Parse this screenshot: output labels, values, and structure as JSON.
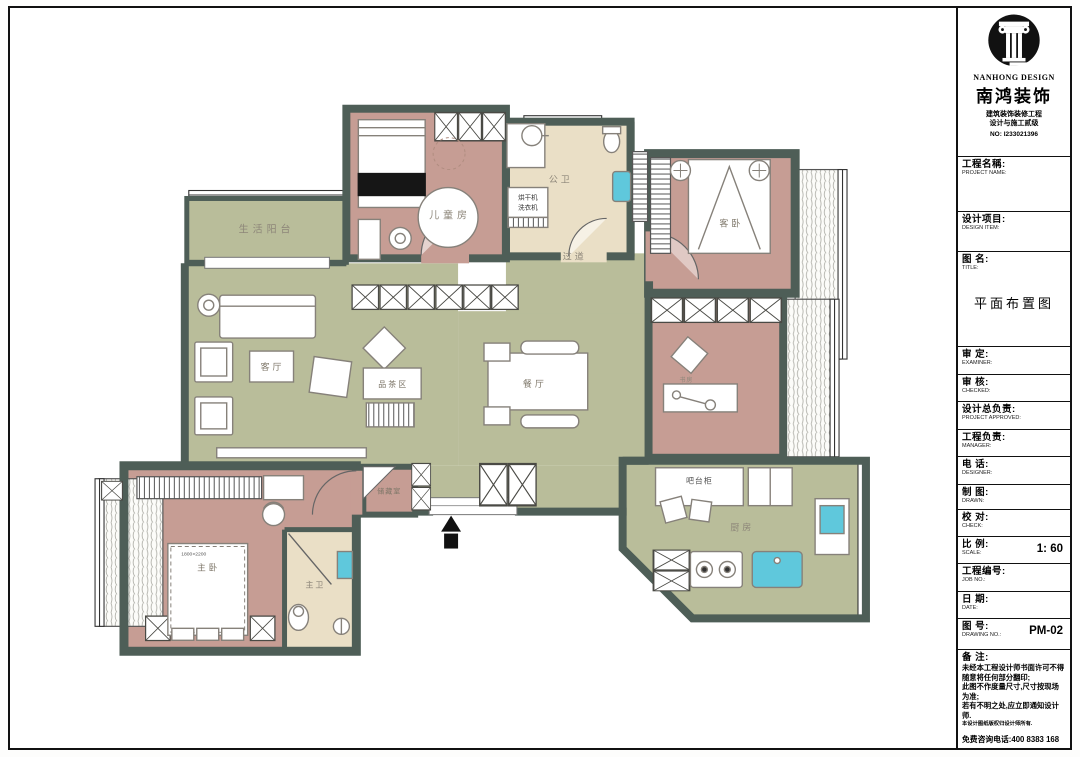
{
  "title_block": {
    "logo": {
      "brand_en": "NANHONG DESIGN",
      "brand_cn": "南鸿装饰",
      "cert_line1": "建筑装饰装修工程",
      "cert_line2": "设计与施工贰级",
      "license_no": "NO: I233021396"
    },
    "fields": [
      {
        "cn": "工程名稱:",
        "en": "PROJECT NAME:",
        "value": ""
      },
      {
        "cn": "设计项目:",
        "en": "DESIGN ITEM:",
        "value": ""
      },
      {
        "cn": "图  名:",
        "en": "TITLE:",
        "value": "平面布置图"
      },
      {
        "cn": "审  定:",
        "en": "EXAMINER:",
        "value": ""
      },
      {
        "cn": "审  核:",
        "en": "CHECKED:",
        "value": ""
      },
      {
        "cn": "设计总负责:",
        "en": "PROJECT APPROVED:",
        "value": ""
      },
      {
        "cn": "工程负责:",
        "en": "MANAGER:",
        "value": ""
      },
      {
        "cn": "电  话:",
        "en": "DESIGNER:",
        "value": ""
      },
      {
        "cn": "制  图:",
        "en": "DRAWN:",
        "value": ""
      },
      {
        "cn": "校  对:",
        "en": "CHECK:",
        "value": ""
      },
      {
        "cn": "比  例:",
        "en": "SCALE:",
        "value": "1: 60"
      },
      {
        "cn": "工程编号:",
        "en": "JOB NO.:",
        "value": ""
      },
      {
        "cn": "日  期:",
        "en": "DATE:",
        "value": ""
      },
      {
        "cn": "图  号:",
        "en": "DRAWING NO.:",
        "value": "PM-02"
      }
    ],
    "remarks": {
      "label": "备  注:",
      "lines": [
        "未经本工程设计师书面许可不得",
        "随意将任何部分翻印;",
        "此图不作度量尺寸,尺寸按现场",
        "为准;",
        "若有不明之处,应立即通知设计",
        "师.",
        "本设计图纸版权归设计师所有."
      ],
      "hotline": "免费咨询电话:400 8383 168"
    }
  },
  "floor_plan": {
    "rooms": [
      {
        "id": "life-balcony",
        "label": "生活阳台"
      },
      {
        "id": "kids-room",
        "label": "儿童房"
      },
      {
        "id": "public-bath",
        "label": "公卫"
      },
      {
        "id": "hallway",
        "label": "过道"
      },
      {
        "id": "guest-bedroom",
        "label": "客卧"
      },
      {
        "id": "living-room",
        "label": "客厅"
      },
      {
        "id": "tea-area",
        "label": "品茶区"
      },
      {
        "id": "dining-room",
        "label": "餐厅"
      },
      {
        "id": "study",
        "label": "书房"
      },
      {
        "id": "master-bedroom",
        "label": "主卧"
      },
      {
        "id": "master-bath",
        "label": "主卫"
      },
      {
        "id": "storage",
        "label": "储藏室"
      },
      {
        "id": "bar-cabinet",
        "label": "吧台柜"
      },
      {
        "id": "kitchen",
        "label": "厨房"
      }
    ],
    "annotations": {
      "dryer": "烘干机",
      "washer": "洗衣机",
      "master_bed_size": "1800×2200"
    },
    "colors": {
      "wall": "#4e5e57",
      "floor_green": "#b9bd9a",
      "room_pink": "#c69d94",
      "bath_beige": "#eadfc6",
      "fixture_cyan": "#5fc8dc"
    }
  }
}
